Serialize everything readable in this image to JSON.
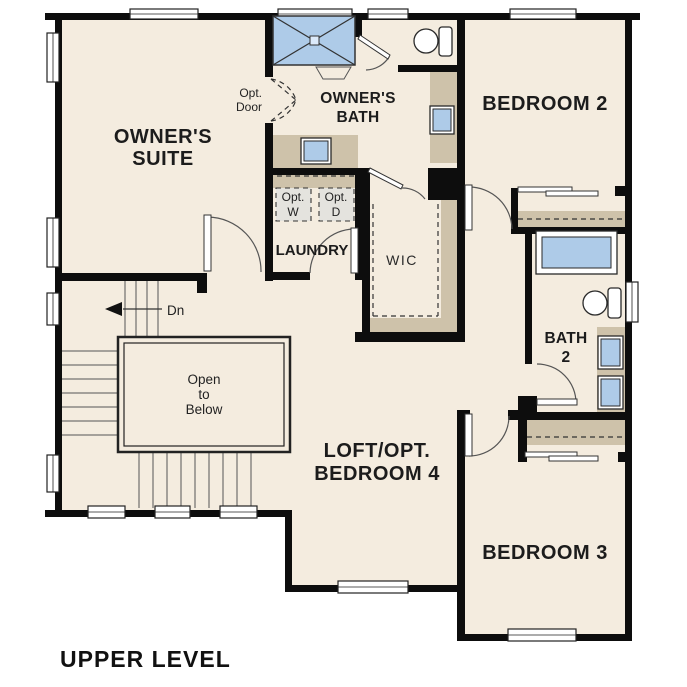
{
  "plan": {
    "level_label": "UPPER LEVEL",
    "rooms": {
      "owners_suite": {
        "lines": [
          "OWNER'S",
          "SUITE"
        ]
      },
      "owners_bath": {
        "lines": [
          "OWNER'S",
          "BATH"
        ]
      },
      "bedroom2": {
        "label": "BEDROOM 2"
      },
      "bedroom3": {
        "label": "BEDROOM 3"
      },
      "loft": {
        "lines": [
          "LOFT/OPT.",
          "BEDROOM 4"
        ]
      },
      "laundry": {
        "label": "LAUNDRY"
      },
      "wic": {
        "label": "WIC"
      },
      "bath2": {
        "lines": [
          "BATH",
          "2"
        ]
      },
      "open_to_below": {
        "lines": [
          "Open",
          "to",
          "Below"
        ]
      }
    },
    "annotations": {
      "stairs_down": "Dn",
      "opt_door": {
        "lines": [
          "Opt.",
          "Door"
        ]
      },
      "opt_washer": {
        "lines": [
          "Opt.",
          "W"
        ]
      },
      "opt_dryer": {
        "lines": [
          "Opt.",
          "D"
        ]
      }
    },
    "colors": {
      "background": "#ffffff",
      "floor": "#f4ecdf",
      "wall": "#0d0d0d",
      "fixture_blue": "#aecbe8",
      "counter_tan": "#cec2aa",
      "appliance_gray": "#e4e3de"
    }
  }
}
